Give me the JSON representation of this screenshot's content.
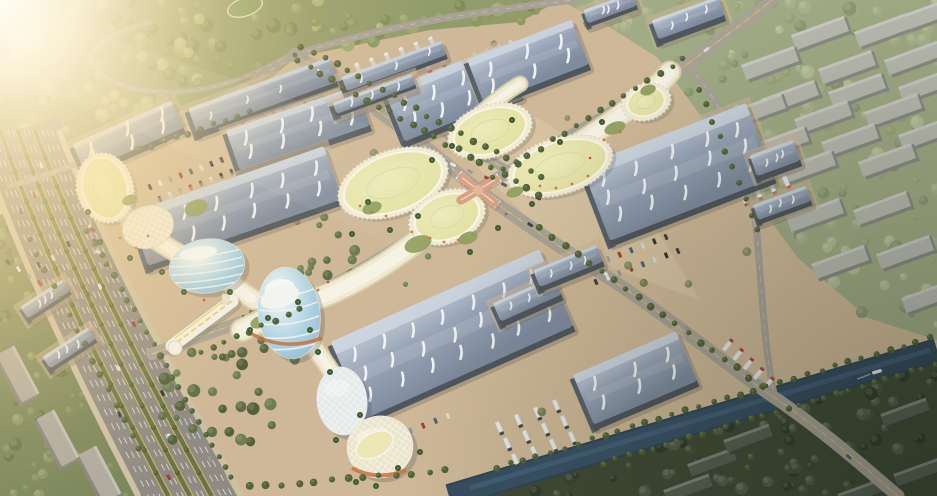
{
  "scene": {
    "label": "Aerial rendering of an exhibition and trade market complex",
    "lighting": "sun-flare-top-left",
    "inventory": {
      "exhibition_halls": 19,
      "retail_ribbon_buildings": 6,
      "egg_towers": 4,
      "residential_slabs_northeast": 22,
      "residential_slabs_southwest": 3,
      "residential_slabs_southeast": 6,
      "roads": [
        "boulevard-highway",
        "main-avenue",
        "cross-avenue",
        "market-street",
        "forest-road",
        "edge-road"
      ],
      "water": "canal-with-boat",
      "bridges": [
        "pedestrian-bridge",
        "canal-road-bridge"
      ],
      "central_feature": "x-shaped-canopy-intersection"
    }
  },
  "palette": {
    "ground": "#cbb493",
    "groundLight": "#dcc9a8",
    "plaza": "#d5bf9f",
    "forestBase": "#8a9663",
    "forestBlobs": [
      "#97a468",
      "#86935a",
      "#a8b274",
      "#78864e"
    ],
    "neBase": "#9aa67f",
    "neBlobs": [
      "#a3ae85",
      "#93a074",
      "#b0ba92",
      "#85926a"
    ],
    "seBase": "#333f2b",
    "seBlobs": [
      "#2e3a26",
      "#3b4830",
      "#24301e",
      "#465340"
    ],
    "swBase": "#6f7d52",
    "swBlobs": [
      "#70804f",
      "#5c6c40",
      "#83905f"
    ],
    "roofTop": "#c2ccda",
    "roofMid": "#93a1b6",
    "roofDark": "#76849a",
    "roofEdge": "#cfd8e4",
    "streak": "#f4f7fb",
    "wallSide": "#434b54",
    "wallEnd": "#4e5861",
    "asphalt": "#a39d93",
    "asphaltHwy": "#87837d",
    "laneWhite": "#e9e9e4",
    "laneYellow": "#cdb74a",
    "verge": "#5d6b44",
    "canal": "#2d4961",
    "canalLight": "#44658a",
    "canalDeep": "#223a4e",
    "cream": "#efe9d2",
    "creamDeep": "#d9d0ae",
    "creamRim": "#f9f6e8",
    "roofYellow1": "#ecebb9",
    "roofYellow2": "#dedd96",
    "garden": "#8a9a57",
    "orange": "#c06a33",
    "red": "#b73a33",
    "canopy": "#d49a7b",
    "eggHi": "#f6fafa",
    "eggBlue": "#a7cfe2",
    "eggDeep": "#7fb0c9",
    "gridShell": "#e3eaec",
    "gridCream": "#eae4cc",
    "slabTopNE": "#b4b6ae",
    "slabSideNE": "#83857d",
    "slabTopSW": "#a8a59d",
    "slabSideSW": "#7e7b74",
    "slabTopSE": "#4d554a",
    "slabSideSE": "#353c32",
    "cornerBldg": "#dcd8ca",
    "treeRow": "#46582f",
    "treeRowHi": "#5d7340",
    "palm": "#2f4c28",
    "palmHi": "#547a3a",
    "carColors": [
      "#30343a",
      "#e6e7e8",
      "#8e949b",
      "#99342e",
      "#4a5568",
      "#d9dadb",
      "#23272c"
    ],
    "truckBody": "#e8e9ea",
    "truckRed": "#b23b30",
    "truckDark": "#3a3f46",
    "bridgeWhite": "#f2f0ea",
    "bridgeYellow": "#e8c84c",
    "flare1": "#fffdf4",
    "flare2": "#ffecc0",
    "flare3": "#ffdfa3",
    "warmWash": "#ffedd0",
    "vignette": "#0c150c",
    "parkOval": "#7f9a5c",
    "boat": "#e8e6df"
  }
}
